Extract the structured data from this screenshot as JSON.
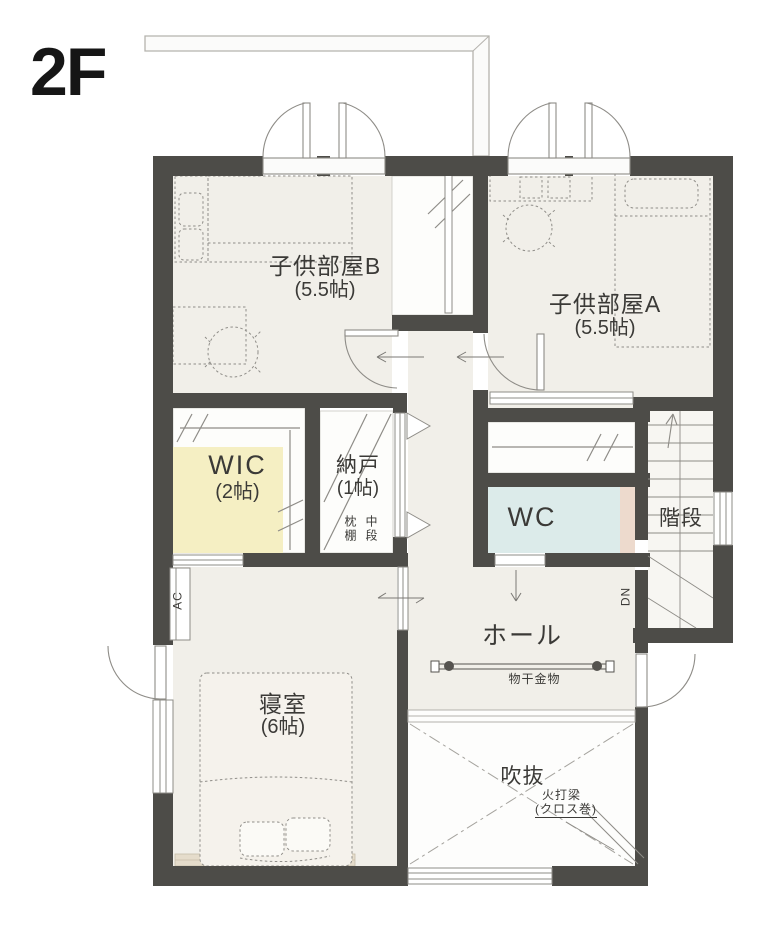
{
  "plan": {
    "floor_label": "2F",
    "rooms": {
      "kids_b": {
        "name": "子供部屋B",
        "size": "(5.5帖)"
      },
      "kids_a": {
        "name": "子供部屋A",
        "size": "(5.5帖)"
      },
      "wic": {
        "name": "WIC",
        "size": "(2帖)"
      },
      "nando": {
        "name": "納戸",
        "size": "(1帖)"
      },
      "wc": {
        "name": "WC"
      },
      "stairs": {
        "name": "階段"
      },
      "hall": {
        "name": "ホール"
      },
      "bedroom": {
        "name": "寝室",
        "size": "(6帖)"
      },
      "void": {
        "name": "吹抜"
      }
    },
    "annotations": {
      "laundry_hardware": "物干金物",
      "fire_beam_line1": "火打梁",
      "fire_beam_line2": "(クロス巻)",
      "pillow_shelf": "枕棚",
      "middle_shelf": "中段",
      "down": "DN",
      "ac": "AC"
    },
    "colors": {
      "wall": "#4d4c48",
      "floor": "#f1efe9",
      "closet": "#fdfdfb",
      "wic_floor": "#f5efc3",
      "wc_floor": "#dcebea",
      "wc_counter": "#eddacd",
      "bed_head_counter": "#e5dccb",
      "line": "#8e8c87",
      "furniture_line": "#908e89"
    }
  }
}
